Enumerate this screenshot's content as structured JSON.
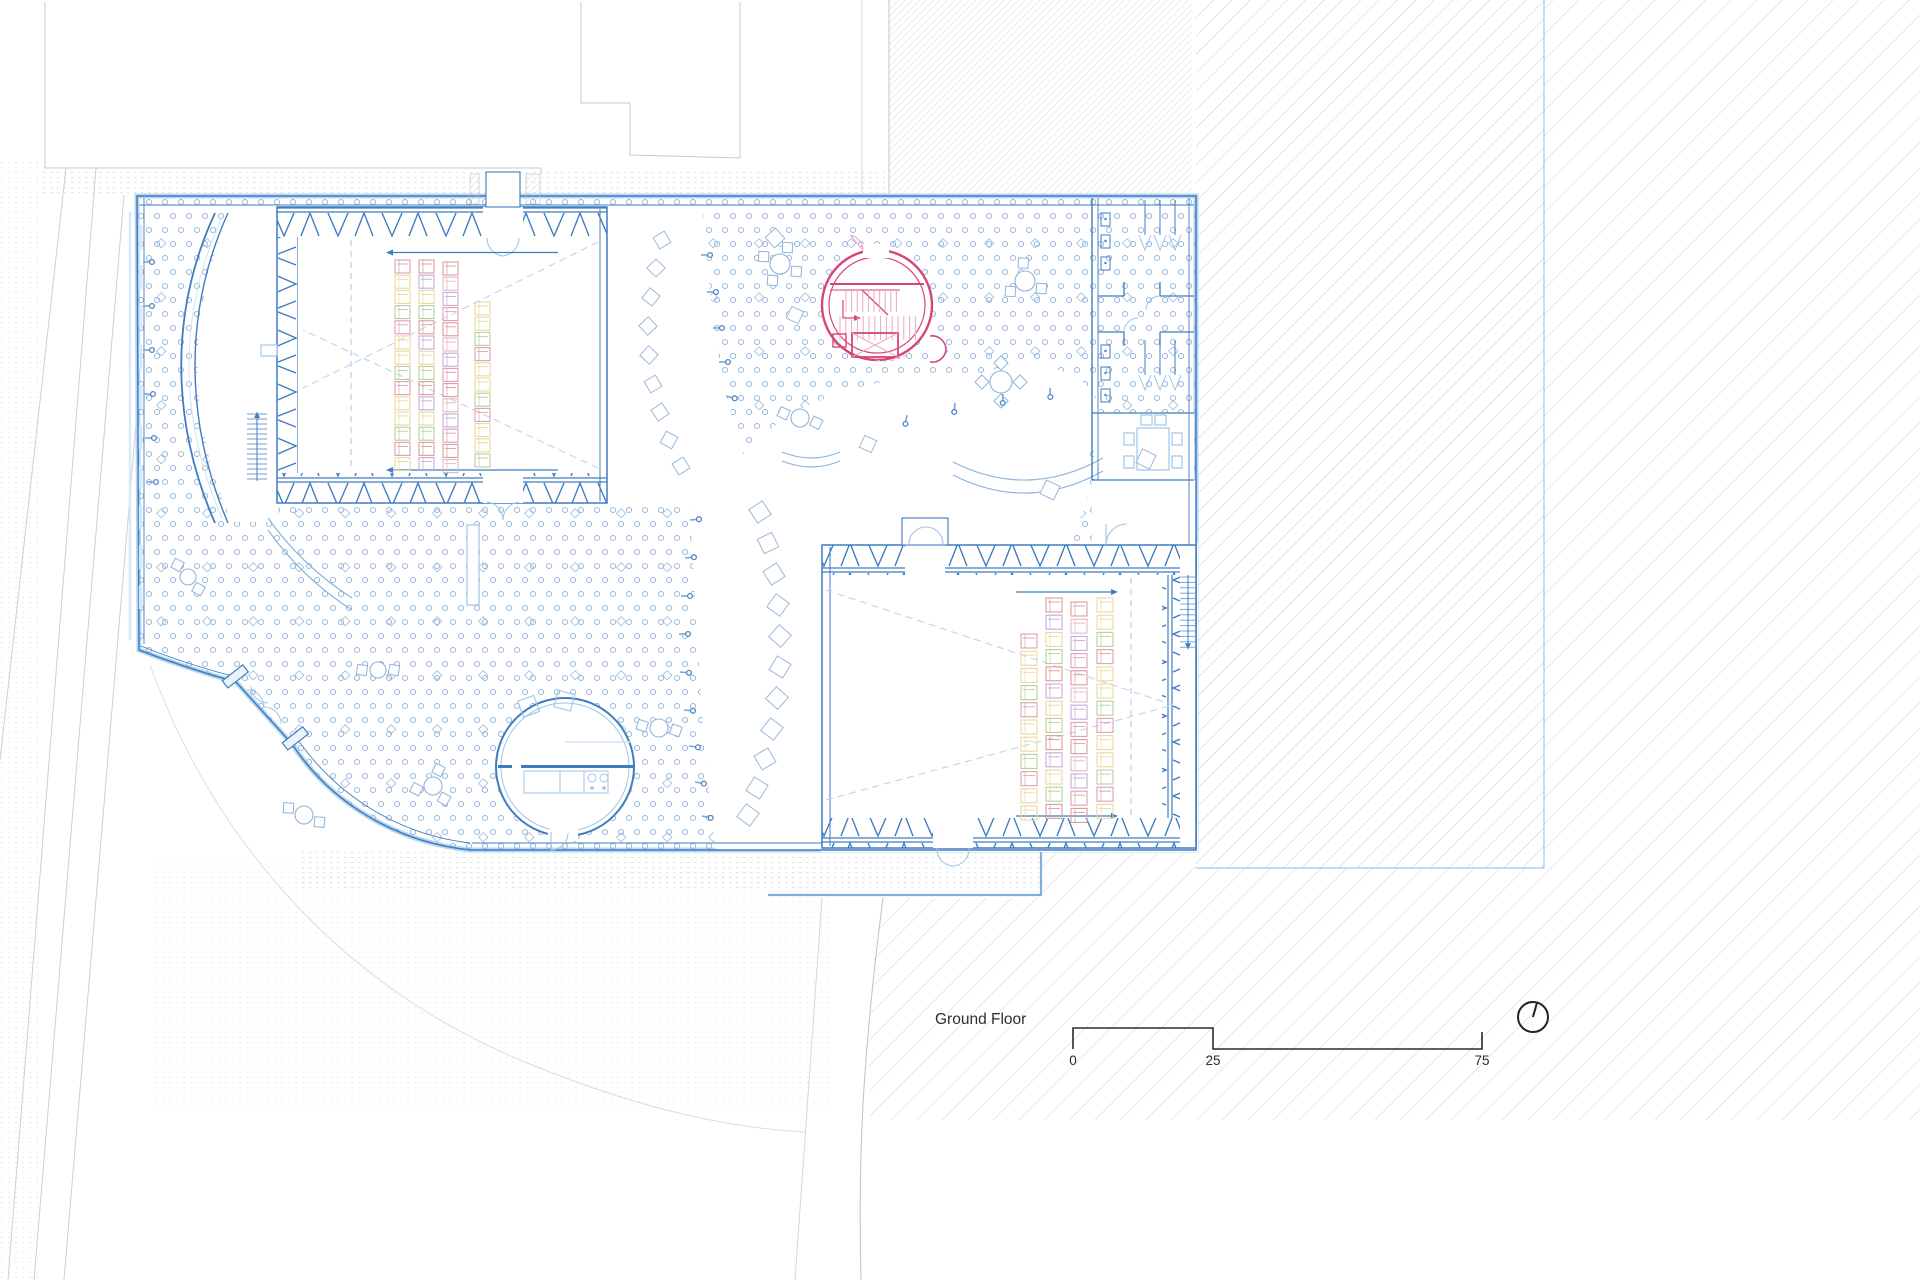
{
  "drawing": {
    "floor_label": "Ground Floor",
    "scale_bar": {
      "tick_start": "0",
      "tick_mid": "25",
      "tick_end": "75"
    },
    "north_icon": "north-bearing-circle"
  },
  "colors": {
    "wall_blue": "#3f7cc0",
    "wall_casing": "#b9d7f0",
    "light_blue": "#9fc4e8",
    "dot_blue": "#8fb3da",
    "dash_blue": "#bcd4ea",
    "pink": "#d64579",
    "pale_pink": "#eba9c3",
    "site_gray": "#c9c9c9",
    "hatch_gray": "#d2d2d2",
    "hatch_blue": "#a9c9e7",
    "text_dark": "#2e2e2e"
  },
  "seating": {
    "palette": [
      "#df9fb0",
      "#e3b7c4",
      "#b9cf9b",
      "#ead9a0",
      "#c3abd6",
      "#dc9c9c",
      "#ead9a0",
      "#df9fb0",
      "#c3abd6",
      "#b9cf9b",
      "#dc9c9c",
      "#ead9a0"
    ],
    "aud_a": {
      "seat_w": 15,
      "seat_h": 13,
      "pitch": 15.2,
      "cols": [
        {
          "x": 395,
          "y0": 260,
          "n": 14
        },
        {
          "x": 419,
          "y0": 260,
          "n": 14
        },
        {
          "x": 443,
          "y0": 262,
          "n": 14
        },
        {
          "x": 475,
          "y0": 302,
          "n": 11
        }
      ]
    },
    "aud_b": {
      "seat_w": 16,
      "seat_h": 14,
      "pitch": 17.2,
      "cols": [
        {
          "x": 1021,
          "y0": 634,
          "n": 11
        },
        {
          "x": 1046,
          "y0": 598,
          "n": 13
        },
        {
          "x": 1071,
          "y0": 602,
          "n": 13
        },
        {
          "x": 1097,
          "y0": 598,
          "n": 13
        }
      ]
    }
  },
  "furniture": {
    "tables": [
      {
        "cx": 780,
        "cy": 264,
        "r": 10,
        "chairs": "sq4"
      },
      {
        "cx": 1025,
        "cy": 281,
        "r": 10,
        "chairs": "sq3"
      },
      {
        "cx": 1001,
        "cy": 382,
        "r": 11,
        "chairs": "dia4"
      },
      {
        "cx": 800,
        "cy": 418,
        "r": 9,
        "chairs": "sq2"
      },
      {
        "cx": 188,
        "cy": 577,
        "r": 8,
        "chairs": "sq2"
      },
      {
        "cx": 433,
        "cy": 786,
        "r": 9,
        "chairs": "sq3"
      },
      {
        "cx": 659,
        "cy": 728,
        "r": 9,
        "chairs": "sq2"
      },
      {
        "cx": 378,
        "cy": 670,
        "r": 8,
        "chairs": "sq2"
      },
      {
        "cx": 304,
        "cy": 815,
        "r": 9,
        "chairs": "sq2"
      }
    ],
    "diamond_stools_arc_a": [
      [
        662,
        240
      ],
      [
        656,
        268
      ],
      [
        651,
        297
      ],
      [
        648,
        326
      ],
      [
        649,
        355
      ],
      [
        653,
        384
      ],
      [
        660,
        412
      ],
      [
        669,
        440
      ],
      [
        681,
        466
      ]
    ],
    "diamond_stools_arc_b": [
      [
        760,
        512
      ],
      [
        768,
        543
      ],
      [
        774,
        574
      ],
      [
        778,
        605
      ],
      [
        780,
        636
      ],
      [
        780,
        667
      ],
      [
        777,
        698
      ],
      [
        772,
        729
      ],
      [
        765,
        759
      ],
      [
        757,
        788
      ],
      [
        748,
        815
      ]
    ],
    "diamond_stools_free": [
      [
        775,
        238,
        14
      ],
      [
        795,
        315,
        13
      ],
      [
        1146,
        459,
        15
      ],
      [
        1050,
        490,
        15
      ],
      [
        868,
        444,
        13
      ]
    ],
    "benches": [
      {
        "d": "M 953,462 Q 1028,500 1103,458",
        "w": 13
      },
      {
        "d": "M 782,452 Q 812,464 840,452",
        "w": 9
      },
      {
        "d": "M 268,518 Q 302,566 352,598",
        "w": 12
      }
    ],
    "bench_rect": {
      "x": 467,
      "y": 525,
      "w": 12,
      "h": 80
    },
    "pins": [
      [
        701,
        255,
        0
      ],
      [
        707,
        292,
        0
      ],
      [
        713,
        328,
        0
      ],
      [
        719,
        362,
        0
      ],
      [
        726,
        396,
        15
      ],
      [
        907,
        415,
        100
      ],
      [
        955,
        403,
        95
      ],
      [
        1003,
        394,
        92
      ],
      [
        1050,
        388,
        88
      ],
      [
        690,
        520,
        -5
      ],
      [
        685,
        558,
        -5
      ],
      [
        681,
        596,
        0
      ],
      [
        679,
        634,
        0
      ],
      [
        680,
        672,
        5
      ],
      [
        684,
        710,
        5
      ],
      [
        689,
        746,
        8
      ],
      [
        695,
        782,
        10
      ],
      [
        702,
        816,
        12
      ],
      [
        143,
        262,
        0
      ],
      [
        143,
        306,
        0
      ],
      [
        143,
        350,
        0
      ],
      [
        144,
        394,
        0
      ],
      [
        145,
        438,
        0
      ],
      [
        147,
        482,
        0
      ]
    ]
  },
  "stairs": [
    {
      "x": 247,
      "y": 414,
      "w": 20,
      "n": 13,
      "dy": 5.0,
      "arrow": "up"
    },
    {
      "x": 1180,
      "y": 577,
      "w": 16,
      "n": 13,
      "dy": 5.4,
      "arrow": "down"
    }
  ]
}
